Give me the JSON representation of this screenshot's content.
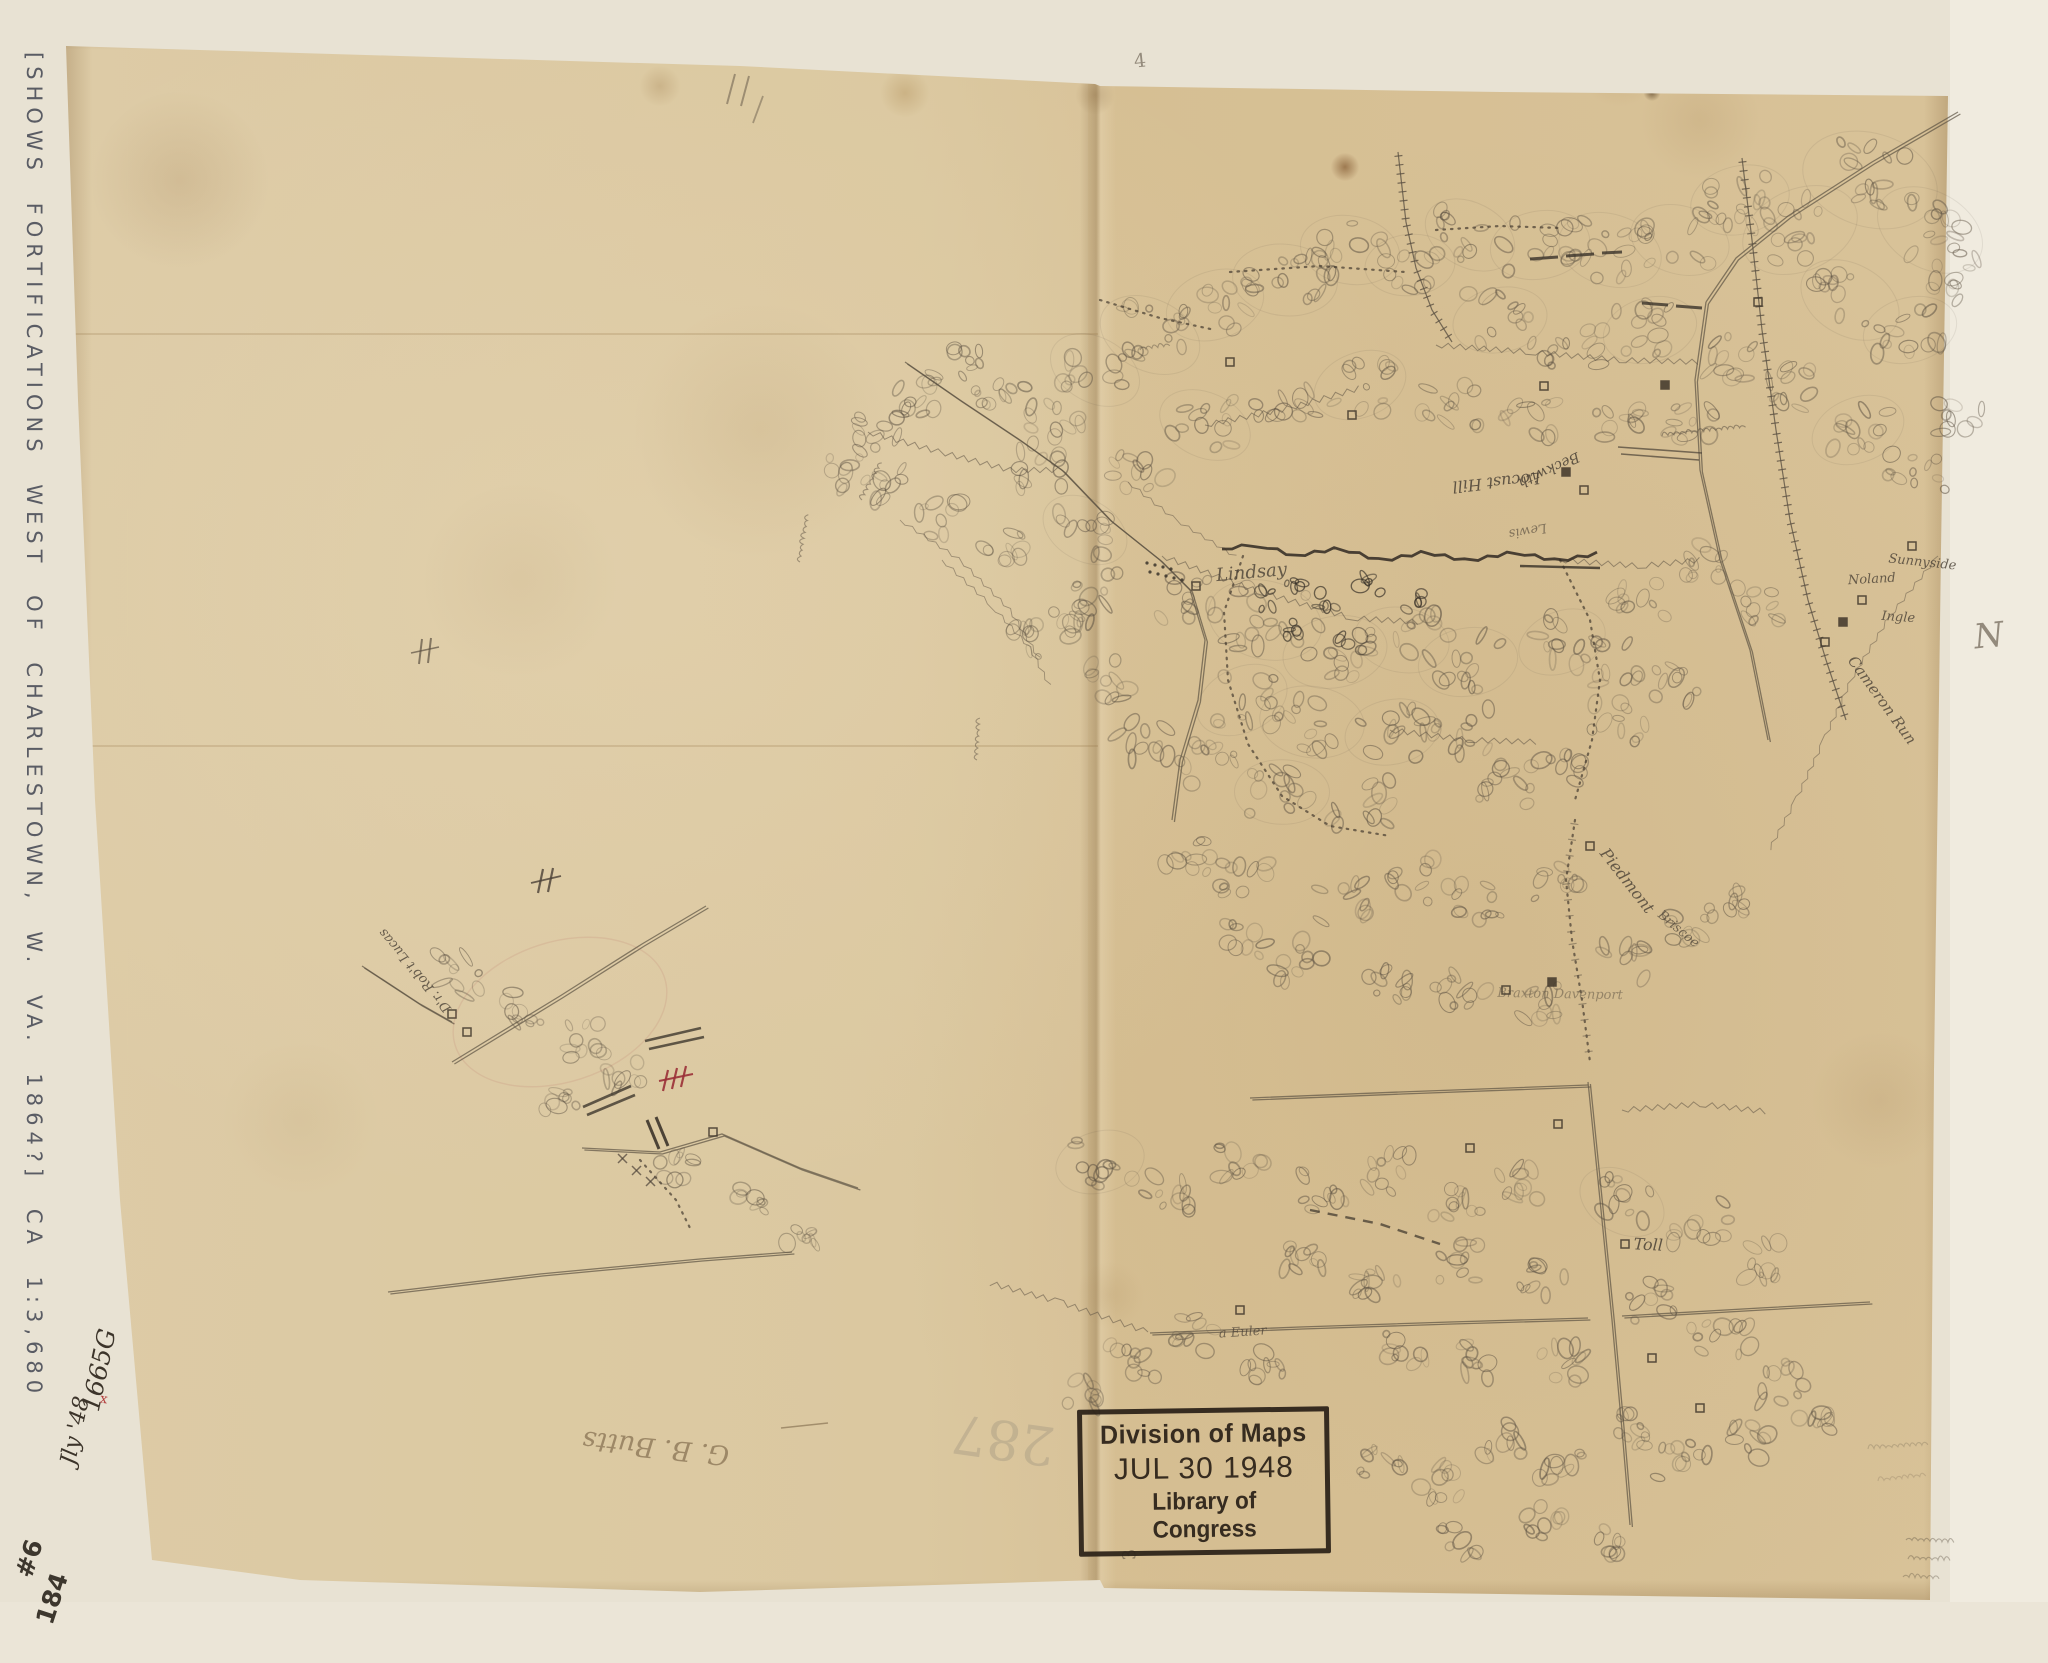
{
  "margin": {
    "left_note": "[SHOWS FORTIFICATIONS WEST OF CHARLESTOWN, W. VA. 1864?]  CA 1:3,680",
    "corner_mark_top": "#6",
    "corner_mark_bottom": "184",
    "north_letter": "N"
  },
  "paper_notes": {
    "accession_number": "1665G",
    "accession_date": "Jly '48",
    "red_check": "x",
    "faint_number": "287",
    "signature": "G. B. Butts",
    "top_mark": "4",
    "bottom_mark": "3"
  },
  "stamp": {
    "line1": "Division of Maps",
    "line2": "JUL 30 1948",
    "line3": "Library of Congress"
  },
  "map_labels": [
    {
      "text": "Lindsay",
      "x": 1252,
      "y": 578,
      "rot": -5,
      "size": 18,
      "op": 0.8
    },
    {
      "text": "Locust Hill",
      "x": 1496,
      "y": 477,
      "rot": 174,
      "size": 16,
      "op": 0.85
    },
    {
      "text": "Beckwith",
      "x": 1547,
      "y": 466,
      "rot": 155,
      "size": 14,
      "op": 0.85
    },
    {
      "text": "Lewis",
      "x": 1527,
      "y": 527,
      "rot": 170,
      "size": 13,
      "op": 0.6
    },
    {
      "text": "Sunnyside",
      "x": 1922,
      "y": 566,
      "rot": 6,
      "size": 13,
      "op": 0.8
    },
    {
      "text": "Noland",
      "x": 1872,
      "y": 583,
      "rot": -3,
      "size": 13,
      "op": 0.8
    },
    {
      "text": "Ingle",
      "x": 1898,
      "y": 621,
      "rot": 4,
      "size": 13,
      "op": 0.8
    },
    {
      "text": "Cameron Run",
      "x": 1878,
      "y": 703,
      "rot": 54,
      "size": 15,
      "op": 0.8
    },
    {
      "text": "Piedmont",
      "x": 1623,
      "y": 884,
      "rot": 52,
      "size": 16,
      "op": 0.8
    },
    {
      "text": "Briscoe",
      "x": 1676,
      "y": 932,
      "rot": 40,
      "size": 13,
      "op": 0.7
    },
    {
      "text": "Braxton Davenport",
      "x": 1560,
      "y": 998,
      "rot": 1,
      "size": 13,
      "op": 0.45
    },
    {
      "text": "Toll",
      "x": 1648,
      "y": 1250,
      "rot": 3,
      "size": 16,
      "op": 0.85
    },
    {
      "text": "a Euler",
      "x": 1243,
      "y": 1336,
      "rot": -4,
      "size": 13,
      "op": 0.7
    },
    {
      "text": "D'r. Rob't Lucas",
      "x": 418,
      "y": 968,
      "rot": -130,
      "size": 13,
      "op": 0.8
    }
  ],
  "colors": {
    "paper": "#d9c59c",
    "pencil": "#5d5243",
    "stamp_ink": "#2b2118",
    "red_mark": "#9b3038",
    "margin_ink": "#474a55"
  }
}
